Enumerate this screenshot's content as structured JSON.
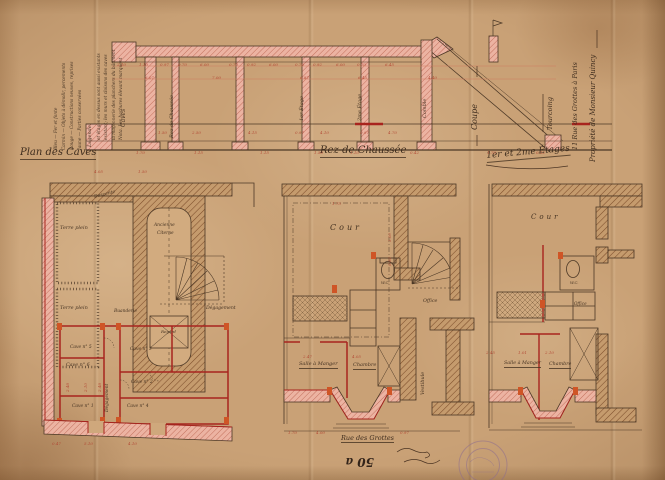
{
  "colors": {
    "paper": "#c9a176",
    "ink": "#4c3826",
    "red_ink": "#a8241e",
    "dim_red": "#b0402e",
    "pink_wall": "#ecb3a2",
    "brown_wall": "#c59b6d",
    "orange_accent": "#cf5526",
    "stamp_violet": "#8f6e8e"
  },
  "labels": [
    {
      "n": "plan-caves-title",
      "t": "Plan des Caves",
      "x": 20,
      "y": 148,
      "s": 10,
      "c": "t",
      "u": 1
    },
    {
      "n": "rdc-title",
      "t": "Rez-de-Chaussée",
      "x": 320,
      "y": 146,
      "s": 10,
      "c": "t",
      "u": 1
    },
    {
      "n": "etages-title",
      "t": "1er et 2me Étages",
      "x": 486,
      "y": 152,
      "s": 9,
      "c": "t",
      "u": 1,
      "r": -5
    },
    {
      "n": "coupe-title",
      "t": "Coupe",
      "x": 471,
      "y": 130,
      "s": 8,
      "c": "t",
      "r": -90
    },
    {
      "n": "level-caves",
      "t": "Caves",
      "x": 121,
      "y": 127,
      "s": 6,
      "c": "v",
      "r": -90
    },
    {
      "n": "level-rdc",
      "t": "Rez de Chaussée",
      "x": 170,
      "y": 138,
      "s": 5,
      "c": "v",
      "r": -90
    },
    {
      "n": "level-1er",
      "t": "1er Étage",
      "x": 300,
      "y": 121,
      "s": 5,
      "c": "v",
      "r": -90
    },
    {
      "n": "level-2me",
      "t": "2me Étage",
      "x": 358,
      "y": 121,
      "s": 5,
      "c": "v",
      "r": -90
    },
    {
      "n": "level-comble",
      "t": "Comble",
      "x": 423,
      "y": 118,
      "s": 5,
      "c": "v",
      "r": -90
    },
    {
      "n": "owner-line",
      "t": "Propriété de Monsieur Quincy",
      "x": 590,
      "y": 162,
      "s": 7,
      "c": "t",
      "r": -90
    },
    {
      "n": "address-line",
      "t": "11 Rue des Grottes à Paris",
      "x": 572,
      "y": 150,
      "s": 6.5,
      "c": "t",
      "r": -90
    },
    {
      "n": "city-line",
      "t": "Tourcoing",
      "x": 547,
      "y": 130,
      "s": 6.5,
      "c": "t",
      "r": -90
    },
    {
      "n": "nota-line-1",
      "t": "Nota. Les hachures élevant marquent",
      "x": 120,
      "y": 140,
      "s": 4.3,
      "c": "lg",
      "r": -90
    },
    {
      "n": "nota-line-2",
      "t": "la maçonnerie des planchers du bâtiment",
      "x": 112.5,
      "y": 140,
      "s": 4.3,
      "c": "lg",
      "r": -90
    },
    {
      "n": "nota-line-3",
      "t": "existant; les murs et cloisons des caves",
      "x": 105,
      "y": 140,
      "s": 4.3,
      "c": "lg",
      "r": -90
    },
    {
      "n": "nota-line-4",
      "t": "et étages en dessus sont aussi existants",
      "x": 97.5,
      "y": 140,
      "s": 4.3,
      "c": "lg",
      "r": -90
    },
    {
      "n": "legende-heading",
      "t": "Légende:",
      "x": 88,
      "y": 147,
      "s": 5,
      "c": "lg",
      "r": -90
    },
    {
      "n": "legende-jaune",
      "t": "Jaune — Parties conservées",
      "x": 79,
      "y": 150,
      "s": 4.3,
      "c": "lg",
      "r": -90
    },
    {
      "n": "legende-rouge",
      "t": "Rouge — Constructions neuves, reprises",
      "x": 71,
      "y": 150,
      "s": 4.3,
      "c": "lg",
      "r": -90
    },
    {
      "n": "legende-carmin",
      "t": "Carmin — Objets à démolir, percements",
      "x": 63,
      "y": 150,
      "s": 4.3,
      "c": "lg",
      "r": -90
    },
    {
      "n": "legende-bleu",
      "t": "Bleu — Fer et fonte",
      "x": 55,
      "y": 150,
      "s": 4.3,
      "c": "lg",
      "r": -90
    },
    {
      "n": "terre-plein-1",
      "t": "Terre plein",
      "x": 60,
      "y": 226,
      "s": 5
    },
    {
      "n": "terre-plein-2",
      "t": "Terre plein",
      "x": 60,
      "y": 306,
      "s": 5
    },
    {
      "n": "ancienne-label",
      "t": "Ancienne",
      "x": 154,
      "y": 224,
      "s": 4.4
    },
    {
      "n": "citerne-label",
      "t": "Citerne",
      "x": 157,
      "y": 232,
      "s": 4.4
    },
    {
      "n": "regard-label",
      "t": "Regard",
      "x": 161,
      "y": 330,
      "s": 4
    },
    {
      "n": "descente-label",
      "t": "Descente",
      "x": 94,
      "y": 196,
      "s": 4.6,
      "r": -14
    },
    {
      "n": "buanderie-label",
      "t": "Buanderie",
      "x": 114,
      "y": 310,
      "s": 4.4
    },
    {
      "n": "degagement-stair-label",
      "t": "Dégagement",
      "x": 206,
      "y": 307,
      "s": 4.6
    },
    {
      "n": "degagement-corridor-label",
      "t": "Dégagement",
      "x": 106,
      "y": 412,
      "s": 4.4,
      "r": -90
    },
    {
      "n": "cave-5",
      "t": "Cave n° 5",
      "x": 70,
      "y": 346,
      "s": 4.4
    },
    {
      "n": "cave-3",
      "t": "Cave n° 3",
      "x": 130,
      "y": 348,
      "s": 4.4
    },
    {
      "n": "cave-6",
      "t": "Cave n° 6",
      "x": 66,
      "y": 364,
      "s": 4.8
    },
    {
      "n": "cave-1",
      "t": "Cave n° 1",
      "x": 72,
      "y": 405,
      "s": 4.4
    },
    {
      "n": "cave-2",
      "t": "Cave n° 2",
      "x": 131,
      "y": 381,
      "s": 4.4
    },
    {
      "n": "cave-4",
      "t": "Cave n° 4",
      "x": 127,
      "y": 405,
      "s": 4.4
    },
    {
      "n": "cour-rdc",
      "t": "Cour",
      "x": 330,
      "y": 224,
      "s": 8,
      "c": "sp"
    },
    {
      "n": "wc-rdc",
      "t": "W.C.",
      "x": 381,
      "y": 281,
      "s": 3.8
    },
    {
      "n": "office-rdc",
      "t": "Office",
      "x": 423,
      "y": 300,
      "s": 4.8
    },
    {
      "n": "salle-a-manger-rdc",
      "t": "Salle à Manger",
      "x": 299,
      "y": 362,
      "s": 5,
      "u": 1
    },
    {
      "n": "chambre-rdc",
      "t": "Chambre",
      "x": 353,
      "y": 363,
      "s": 5,
      "u": 1
    },
    {
      "n": "vestibule-label",
      "t": "Vestibule",
      "x": 421,
      "y": 395,
      "s": 5,
      "r": -90
    },
    {
      "n": "rue-label",
      "t": "Rue des Grottes",
      "x": 341,
      "y": 435,
      "s": 6.5,
      "c": "t",
      "u": 1
    },
    {
      "n": "cour-etages",
      "t": "Cour",
      "x": 531,
      "y": 214,
      "s": 7,
      "c": "sp"
    },
    {
      "n": "wc-etages",
      "t": "W.C.",
      "x": 570,
      "y": 281,
      "s": 3.8
    },
    {
      "n": "office-etages",
      "t": "Office",
      "x": 574,
      "y": 302,
      "s": 4.2
    },
    {
      "n": "salle-a-manger-etages",
      "t": "Salle à Manger",
      "x": 504,
      "y": 362,
      "s": 4.8,
      "u": 1
    },
    {
      "n": "chambre-etages",
      "t": "Chambre",
      "x": 549,
      "y": 363,
      "s": 4.8,
      "u": 1
    },
    {
      "n": "archive-number",
      "t": "50 a",
      "x": 374,
      "y": 468,
      "s": 12,
      "c": "k",
      "r": 180
    },
    {
      "n": "dim",
      "t": "2.10",
      "x": 117,
      "y": 63,
      "s": 4,
      "c": "d"
    },
    {
      "n": "dim",
      "t": "1.10",
      "x": 139,
      "y": 63,
      "s": 4,
      "c": "d"
    },
    {
      "n": "dim",
      "t": "0.97",
      "x": 160,
      "y": 63,
      "s": 4,
      "c": "d"
    },
    {
      "n": "dim",
      "t": "0.70",
      "x": 178,
      "y": 63,
      "s": 4,
      "c": "d"
    },
    {
      "n": "dim",
      "t": "6.00",
      "x": 200,
      "y": 63,
      "s": 4,
      "c": "d"
    },
    {
      "n": "dim",
      "t": "0.70",
      "x": 229,
      "y": 63,
      "s": 4,
      "c": "d"
    },
    {
      "n": "dim",
      "t": "0.92",
      "x": 247,
      "y": 63,
      "s": 4,
      "c": "d"
    },
    {
      "n": "dim",
      "t": "6.00",
      "x": 269,
      "y": 63,
      "s": 4,
      "c": "d"
    },
    {
      "n": "dim",
      "t": "0.70",
      "x": 295,
      "y": 63,
      "s": 4,
      "c": "d"
    },
    {
      "n": "dim",
      "t": "0.92",
      "x": 313,
      "y": 63,
      "s": 4,
      "c": "d"
    },
    {
      "n": "dim",
      "t": "6.00",
      "x": 336,
      "y": 63,
      "s": 4,
      "c": "d"
    },
    {
      "n": "dim",
      "t": "0.70",
      "x": 357,
      "y": 63,
      "s": 4,
      "c": "d"
    },
    {
      "n": "dim",
      "t": "6.45",
      "x": 385,
      "y": 63,
      "s": 4,
      "c": "d"
    },
    {
      "n": "dim",
      "t": "6.07",
      "x": 145,
      "y": 76,
      "s": 4,
      "c": "d"
    },
    {
      "n": "dim",
      "t": "7.00",
      "x": 212,
      "y": 76,
      "s": 4,
      "c": "d"
    },
    {
      "n": "dim",
      "t": "6.87",
      "x": 300,
      "y": 76,
      "s": 4,
      "c": "d"
    },
    {
      "n": "dim",
      "t": "6.45",
      "x": 358,
      "y": 76,
      "s": 4,
      "c": "d"
    },
    {
      "n": "dim",
      "t": "4.40",
      "x": 428,
      "y": 76,
      "s": 4,
      "c": "d"
    },
    {
      "n": "dim",
      "t": "1.50",
      "x": 158,
      "y": 131,
      "s": 4,
      "c": "d"
    },
    {
      "n": "dim",
      "t": "2.50",
      "x": 192,
      "y": 131,
      "s": 4,
      "c": "d"
    },
    {
      "n": "dim",
      "t": "4.15",
      "x": 248,
      "y": 131,
      "s": 4,
      "c": "d"
    },
    {
      "n": "dim",
      "t": "0.97",
      "x": 295,
      "y": 131,
      "s": 4,
      "c": "d"
    },
    {
      "n": "dim",
      "t": "4.10",
      "x": 320,
      "y": 131,
      "s": 4,
      "c": "d"
    },
    {
      "n": "dim",
      "t": "0.97",
      "x": 360,
      "y": 131,
      "s": 4,
      "c": "d"
    },
    {
      "n": "dim",
      "t": "4.70",
      "x": 388,
      "y": 131,
      "s": 4,
      "c": "d"
    },
    {
      "n": "dim",
      "t": "1.70",
      "x": 136,
      "y": 151,
      "s": 4,
      "c": "d"
    },
    {
      "n": "dim",
      "t": "1.15",
      "x": 194,
      "y": 151,
      "s": 4,
      "c": "d"
    },
    {
      "n": "dim",
      "t": "1.15",
      "x": 260,
      "y": 151,
      "s": 4,
      "c": "d"
    },
    {
      "n": "dim",
      "t": "1.50",
      "x": 314,
      "y": 151,
      "s": 4,
      "c": "d"
    },
    {
      "n": "dim",
      "t": "1.10",
      "x": 350,
      "y": 151,
      "s": 4,
      "c": "d"
    },
    {
      "n": "dim",
      "t": "0.42",
      "x": 410,
      "y": 151,
      "s": 4,
      "c": "d"
    },
    {
      "n": "dim",
      "t": "1.70",
      "x": 487,
      "y": 151,
      "s": 4,
      "c": "d"
    },
    {
      "n": "dim",
      "t": "0.12",
      "x": 536,
      "y": 151,
      "s": 4,
      "c": "d"
    },
    {
      "n": "dim",
      "t": "4.05",
      "x": 94,
      "y": 170,
      "s": 4,
      "c": "d"
    },
    {
      "n": "dim",
      "t": "1.50",
      "x": 138,
      "y": 170,
      "s": 4,
      "c": "d"
    },
    {
      "n": "dim",
      "t": "2.48",
      "x": 66,
      "y": 392,
      "s": 4,
      "c": "d",
      "r": -90
    },
    {
      "n": "dim",
      "t": "2.10",
      "x": 84,
      "y": 392,
      "s": 4,
      "c": "d",
      "r": -90
    },
    {
      "n": "dim",
      "t": "2.48",
      "x": 98,
      "y": 392,
      "s": 4,
      "c": "d",
      "r": -90
    },
    {
      "n": "dim",
      "t": "0.47",
      "x": 52,
      "y": 442,
      "s": 4,
      "c": "d"
    },
    {
      "n": "dim",
      "t": "5.10",
      "x": 84,
      "y": 442,
      "s": 4,
      "c": "d"
    },
    {
      "n": "dim",
      "t": "4.10",
      "x": 128,
      "y": 442,
      "s": 4,
      "c": "d"
    },
    {
      "n": "dim",
      "t": "1.75",
      "x": 332,
      "y": 202,
      "s": 4,
      "c": "d"
    },
    {
      "n": "dim",
      "t": "3.00",
      "x": 388,
      "y": 242,
      "s": 4,
      "c": "d",
      "r": -90
    },
    {
      "n": "dim",
      "t": "0.92",
      "x": 388,
      "y": 266,
      "s": 4,
      "c": "d",
      "r": -90
    },
    {
      "n": "dim",
      "t": "2.47",
      "x": 303,
      "y": 355,
      "s": 4,
      "c": "d"
    },
    {
      "n": "dim",
      "t": "4.05",
      "x": 352,
      "y": 355,
      "s": 4,
      "c": "d"
    },
    {
      "n": "dim",
      "t": "1.70",
      "x": 288,
      "y": 431,
      "s": 4,
      "c": "d"
    },
    {
      "n": "dim",
      "t": "4.00",
      "x": 316,
      "y": 431,
      "s": 4,
      "c": "d"
    },
    {
      "n": "dim",
      "t": "0.97",
      "x": 400,
      "y": 431,
      "s": 4,
      "c": "d"
    },
    {
      "n": "dim",
      "t": "2.45",
      "x": 486,
      "y": 351,
      "s": 4,
      "c": "d"
    },
    {
      "n": "dim",
      "t": "1.01",
      "x": 518,
      "y": 351,
      "s": 4,
      "c": "d"
    },
    {
      "n": "dim",
      "t": "2.10",
      "x": 545,
      "y": 351,
      "s": 4,
      "c": "d"
    }
  ]
}
